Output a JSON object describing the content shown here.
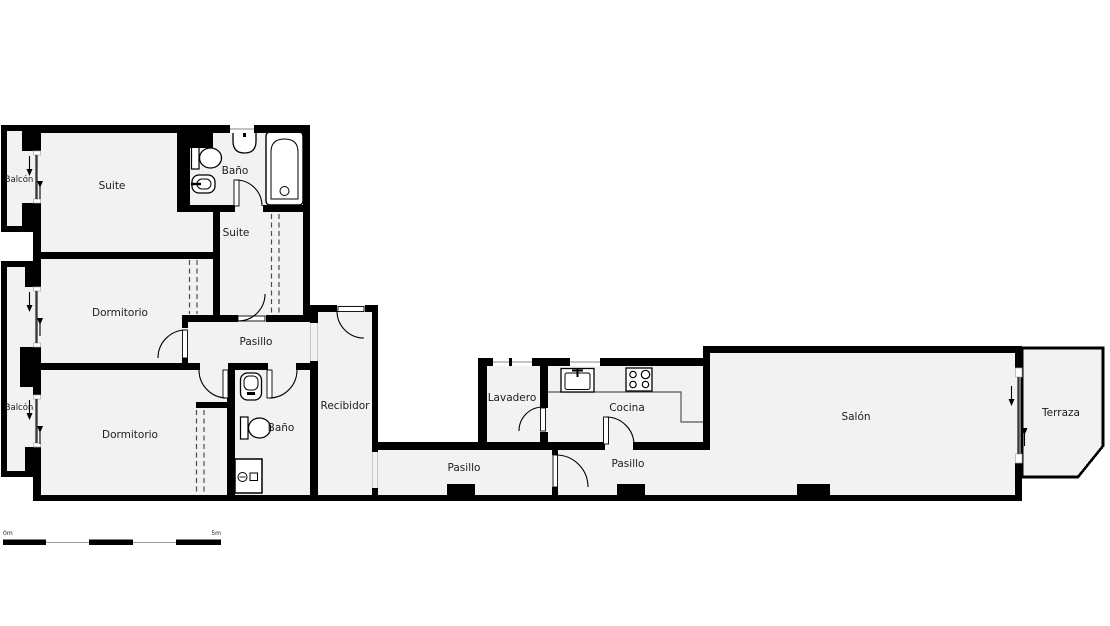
{
  "rooms": {
    "balcon_top": "Balcón",
    "suite": "Suite",
    "bano_suite": "Baño",
    "suite_dressing": "Suite",
    "dormitorio_1": "Dormitorio",
    "pasillo_bedrooms": "Pasillo",
    "balcon_bottom": "Balcón",
    "dormitorio_2": "Dormitorio",
    "bano_2": "Baño",
    "recibidor": "Recibidor",
    "lavadero": "Lavadero",
    "cocina": "Cocina",
    "pasillo_1": "Pasillo",
    "pasillo_2": "Pasillo",
    "salon": "Salón",
    "terraza": "Terraza"
  },
  "scale_bar": {
    "start": "0m",
    "end": "5m"
  },
  "fixtures": [
    "toilet-icon",
    "bidet-icon",
    "washbasin-icon",
    "bathtub-icon",
    "shower-icon",
    "kitchen-sink-icon",
    "stove-icon",
    "wardrobe-dashed-lines",
    "door-swing-arc",
    "sliding-door-arrow"
  ],
  "colors": {
    "wall": "#000000",
    "floor": "#f2f2f2",
    "exterior": "#ffffff",
    "rail": "#3a3a3a",
    "text": "#1c1c1c"
  }
}
